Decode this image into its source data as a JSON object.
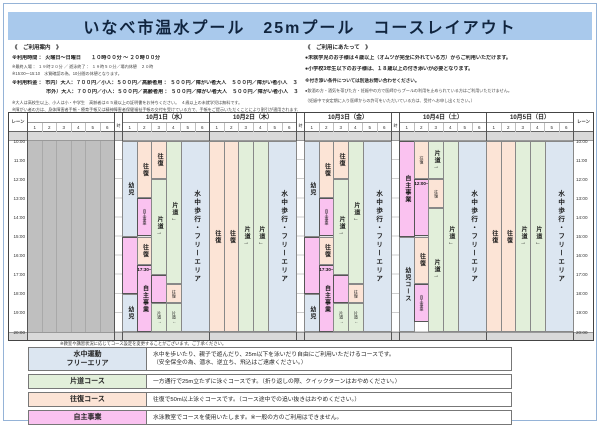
{
  "title": "いなべ市温水プール　25mプール　コースレイアウト",
  "info_left": {
    "heading": "《　ご利用案内　》",
    "lines": [
      {
        "cls": "b",
        "text": "※利用時間 ： 火曜日～日曜日　　１０時００分 ～ ２０時００分"
      },
      {
        "cls": "t",
        "text": "※最終入場 ： １９時２０分 ／ 遊泳終了 ： １９時５０分／場内休憩　２０時"
      },
      {
        "cls": "t",
        "text": "※15:00～15:10　水質確認の為、10分間の休憩となります。"
      },
      {
        "cls": "b gap",
        "text": "※利用料金 ： 市内）大人：７００円／小人：５００円／高齢者用 ： ５００円／障がい者大人　５００円／障がい者小人　３００円"
      },
      {
        "cls": "b ind",
        "text": "市外）大人：７００円／小人：５００円／高齢者用 ： ５００円／障がい者大人　５００円／障がい者小人　３００円"
      },
      {
        "cls": "t gap",
        "text": "※大人は高校生以上、小人は小・中学生　高齢者は６５歳以上の証明書をお持ちください。　４歳以上の未就学児は無料です。"
      },
      {
        "cls": "t",
        "text": "※障がい者の方は、身体障害者手帳・療育手帳又は精神障害者保健福祉手帳の交付を受けている方で、手帳をご提示いただくことにより割引が適用されます。"
      }
    ]
  },
  "info_right": {
    "heading": "《　ご利用にあたって　》",
    "lines": [
      {
        "cls": "b",
        "text": "●未就学児のお子様は４歳以上（オムツが完全に外れている方）からご利用いただけます。"
      },
      {
        "cls": "b",
        "text": "●小学校3年生以下のお子様は、１８歳以上の付き添いが必要となります。"
      },
      {
        "cls": "sb",
        "text": "※付き添い条件については別途お問い合わせください。"
      },
      {
        "cls": "t",
        "text": "●飲酒の方・酒気を帯びた方・妊娠中の方で医師からプールの利用を止められている方はご利用いただけません。"
      },
      {
        "cls": "t",
        "text": "（妊娠中で安定期に入り医師からの許可をいただいている方は、受付へお申し出ください。）"
      }
    ]
  },
  "grid": {
    "lane_header": "レーン",
    "time_header": "時間",
    "lane_numbers": [
      "1",
      "2",
      "3",
      "4",
      "5",
      "6"
    ],
    "times": [
      "10:00",
      "11:00",
      "12:00",
      "13:00",
      "14:00",
      "15:00",
      "16:00",
      "17:00",
      "18:00",
      "19:00",
      "20:00"
    ],
    "days": [
      {
        "date": "10月1日（水）",
        "blocks": [
          {
            "lane": 1,
            "start": 10,
            "end": 15,
            "type": "kids",
            "label": "幼児"
          },
          {
            "lane": 1,
            "start": 15,
            "end": 18,
            "type": "program",
            "label": ""
          },
          {
            "lane": 1,
            "start": 18,
            "end": 20,
            "type": "kids",
            "label": "幼児"
          },
          {
            "lane": 2,
            "start": 10,
            "end": 13,
            "type": "round",
            "label": "往復"
          },
          {
            "lane": 2,
            "start": 13,
            "end": 15,
            "type": "program",
            "label": "自主事業",
            "small": true
          },
          {
            "lane": 2,
            "start": 15,
            "end": 16.5,
            "type": "round",
            "label": "往復"
          },
          {
            "lane": 2,
            "start": 16.5,
            "end": 20,
            "type": "program",
            "label": "自主事業",
            "note": "17:30~"
          },
          {
            "lane": 3,
            "start": 10,
            "end": 12,
            "type": "round",
            "label": "往復"
          },
          {
            "lane": 3,
            "start": 12,
            "end": 17,
            "type": "oneway",
            "label": "片道→"
          },
          {
            "lane": 3,
            "start": 17,
            "end": 18.5,
            "type": "program",
            "label": ""
          },
          {
            "lane": 3,
            "start": 18.5,
            "end": 20,
            "type": "oneway",
            "label": "片道→",
            "small": true
          },
          {
            "lane": 4,
            "start": 10,
            "end": 17.5,
            "type": "oneway",
            "label": "片道←"
          },
          {
            "lane": 4,
            "start": 17.5,
            "end": 18.5,
            "type": "round",
            "label": "往復",
            "small": true
          },
          {
            "lane": 4,
            "start": 18.5,
            "end": 20,
            "type": "oneway",
            "label": "片道←",
            "small": true
          },
          {
            "lane": "5-6",
            "start": 10,
            "end": 20,
            "type": "free",
            "label": "水中歩行・フリーエリア"
          }
        ]
      },
      {
        "date": "10月2日（木）",
        "blocks": [
          {
            "lane": 1,
            "start": 10,
            "end": 20,
            "type": "round",
            "label": "往復"
          },
          {
            "lane": 2,
            "start": 10,
            "end": 20,
            "type": "round",
            "label": "往復"
          },
          {
            "lane": 3,
            "start": 10,
            "end": 20,
            "type": "oneway",
            "label": "片道→"
          },
          {
            "lane": 4,
            "start": 10,
            "end": 20,
            "type": "oneway",
            "label": "片道←"
          },
          {
            "lane": "5-6",
            "start": 10,
            "end": 20,
            "type": "free",
            "label": "水中歩行・フリーエリア"
          }
        ]
      },
      {
        "date": "10月3日（金）",
        "blocks": [
          {
            "lane": 1,
            "start": 10,
            "end": 15,
            "type": "kids",
            "label": "幼児"
          },
          {
            "lane": 1,
            "start": 15,
            "end": 18,
            "type": "program",
            "label": ""
          },
          {
            "lane": 1,
            "start": 18,
            "end": 20,
            "type": "kids",
            "label": "幼児"
          },
          {
            "lane": 2,
            "start": 10,
            "end": 13,
            "type": "round",
            "label": "往復"
          },
          {
            "lane": 2,
            "start": 13,
            "end": 15,
            "type": "program",
            "label": "自主事業",
            "small": true
          },
          {
            "lane": 2,
            "start": 15,
            "end": 16.5,
            "type": "round",
            "label": "往復"
          },
          {
            "lane": 2,
            "start": 16.5,
            "end": 20,
            "type": "program",
            "label": "自主事業",
            "note": "17:30~"
          },
          {
            "lane": 3,
            "start": 10,
            "end": 12,
            "type": "round",
            "label": "往復"
          },
          {
            "lane": 3,
            "start": 12,
            "end": 17,
            "type": "oneway",
            "label": "片道→"
          },
          {
            "lane": 3,
            "start": 17,
            "end": 18.5,
            "type": "program",
            "label": ""
          },
          {
            "lane": 3,
            "start": 18.5,
            "end": 20,
            "type": "oneway",
            "label": "片道→",
            "small": true
          },
          {
            "lane": 4,
            "start": 10,
            "end": 17.5,
            "type": "oneway",
            "label": "片道←"
          },
          {
            "lane": 4,
            "start": 17.5,
            "end": 18.5,
            "type": "round",
            "label": "往復",
            "small": true
          },
          {
            "lane": 4,
            "start": 18.5,
            "end": 20,
            "type": "oneway",
            "label": "片道←",
            "small": true
          },
          {
            "lane": "5-6",
            "start": 10,
            "end": 20,
            "type": "free",
            "label": "水中歩行・フリーエリア"
          }
        ]
      },
      {
        "date": "10月4日（土）",
        "blocks": [
          {
            "lane": 1,
            "start": 10,
            "end": 15,
            "type": "program",
            "label": "自主事業"
          },
          {
            "lane": 1,
            "start": 15,
            "end": 20,
            "type": "kids",
            "label": "幼児コース"
          },
          {
            "lane": 2,
            "start": 10,
            "end": 12,
            "type": "round",
            "label": "往復",
            "small": true
          },
          {
            "lane": 2,
            "start": 12,
            "end": 15,
            "type": "program",
            "label": "",
            "note": "12:00~"
          },
          {
            "lane": 2,
            "start": 15,
            "end": 17.5,
            "type": "round",
            "label": "往復"
          },
          {
            "lane": 2,
            "start": 17.5,
            "end": 19.5,
            "type": "program",
            "label": "自主事業",
            "small": true
          },
          {
            "lane": 3,
            "start": 10,
            "end": 12,
            "type": "oneway",
            "label": "片道→"
          },
          {
            "lane": 3,
            "start": 12,
            "end": 13.5,
            "type": "round",
            "label": "往復",
            "small": true
          },
          {
            "lane": 3,
            "start": 13.5,
            "end": 20,
            "type": "oneway",
            "label": "片道→"
          },
          {
            "lane": 4,
            "start": 10,
            "end": 20,
            "type": "oneway",
            "label": "片道←"
          },
          {
            "lane": "5-6",
            "start": 10,
            "end": 20,
            "type": "free",
            "label": "水中歩行・フリーエリア"
          }
        ]
      },
      {
        "date": "10月5日（日）",
        "blocks": [
          {
            "lane": 1,
            "start": 10,
            "end": 20,
            "type": "round",
            "label": "往復"
          },
          {
            "lane": 2,
            "start": 10,
            "end": 20,
            "type": "round",
            "label": "往復"
          },
          {
            "lane": 3,
            "start": 10,
            "end": 20,
            "type": "oneway",
            "label": "片道→"
          },
          {
            "lane": 4,
            "start": 10,
            "end": 20,
            "type": "oneway",
            "label": "片道←"
          },
          {
            "lane": "5-6",
            "start": 10,
            "end": 20,
            "type": "free",
            "label": "水中歩行・フリーエリア"
          }
        ]
      }
    ]
  },
  "grid_note": "※教室や講習状況に応じてコース設定を変更することがございます。ご了承ください。",
  "legend": {
    "rows": [
      {
        "color": "free",
        "label": "水中運動\nフリーエリア",
        "desc": "水中を歩いたり、親子で遊んだり、25m以下を泳いだり自由にご利用いただけるコースです。\n（安全保全の為、潜水、逆立ち、飛込はご遠慮ください。）"
      },
      {
        "color": "oneway",
        "label": "片道コース",
        "desc": "一方通行で25m立たずに泳ぐコースです。（折り返しの際、クイックターンはおやめください。）"
      },
      {
        "color": "round",
        "label": "往復コース",
        "desc": "往復で50m以上泳ぐコースです。（コース途中での追い抜きはおやめください。）"
      },
      {
        "color": "program",
        "label": "自主事業",
        "desc": "水泳教室でコースを使用いたします。※一般の方のご利用はできません。"
      }
    ]
  },
  "colors": {
    "round": "#fce4d6",
    "oneway": "#e2efda",
    "free": "#dce6f1",
    "kids": "#dce6f1",
    "program": "#fac2f0",
    "ref_gray": "#bfbfbf",
    "title_bg": "#a9c9ec"
  }
}
